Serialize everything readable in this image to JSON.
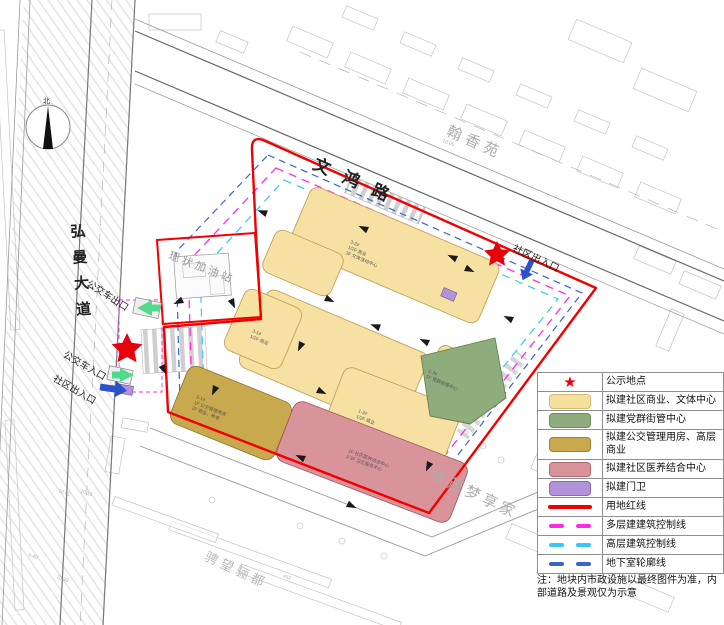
{
  "map": {
    "roads": {
      "top": "文鸿路",
      "left": "弘曼大道"
    },
    "places": {
      "hanxiangyuan": "翰香苑",
      "shimao": "世茂梦享家",
      "chengwang": "骋望骊都",
      "gas_station": "现状加油站"
    },
    "entrances": {
      "bus_exit": "公交车出口",
      "bus_entrance": "公交车入口",
      "community_left": "社区出入口",
      "community_topright": "社区出入口"
    },
    "compass_north": "北",
    "annotations": {
      "building_top": [
        "3-2#",
        "1/2F 商业",
        "3F 文体活动中心"
      ],
      "building_mid": [
        "3-1#",
        "1/2F 商业"
      ],
      "building_br": [
        "1-2#",
        "1/2F 商业"
      ],
      "building_khaki": [
        "2-1#",
        "1F 公交管理用房",
        "2F 商业、养老"
      ],
      "building_pink": [
        "1F 社区医养结合中心",
        "2-3F 卫生服务中心"
      ],
      "building_green": [
        "1-3#",
        "1F 党群街管中心"
      ]
    },
    "elevations": [
      "10.02",
      "10.15",
      "9.40",
      "10.38",
      "10.05",
      "e11"
    ]
  },
  "legend": {
    "items": [
      {
        "type": "star",
        "glyph": "★",
        "label": "公示地点",
        "color": "#E60012"
      },
      {
        "type": "swatch",
        "label": "拟建社区商业、文体中心",
        "color": "#F5DF9E"
      },
      {
        "type": "swatch",
        "label": "拟建党群街管中心",
        "color": "#8FAC7D"
      },
      {
        "type": "swatch",
        "label": "拟建公交管理用房、高层商业",
        "color": "#C9A94E"
      },
      {
        "type": "swatch",
        "label": "拟建社区医养结合中心",
        "color": "#D98F96"
      },
      {
        "type": "swatch",
        "label": "拟建门卫",
        "color": "#B292D8"
      },
      {
        "type": "line",
        "label": "用地红线",
        "color": "#F20000"
      },
      {
        "type": "dash",
        "label": "多层建建筑控制线",
        "color": "#FF2BE2"
      },
      {
        "type": "dash",
        "label": "高层建筑控制线",
        "color": "#35C8F5"
      },
      {
        "type": "dash",
        "label": "地下室轮廓线",
        "color": "#3A66C8"
      }
    ],
    "note": "注：地块内市政设施以最终图件为准，内部道路及景观仅为示意"
  },
  "colors": {
    "boundary_red": "#F20000",
    "multi_storey_control": "#FF2BE2",
    "highrise_control": "#35C8F5",
    "basement_outline": "#3A66C8",
    "commercial_yellow": "#F6E1A2",
    "party_green": "#8FAC7D",
    "bus_khaki": "#C9A94E",
    "medical_pink": "#D9949B",
    "gatehouse_purple": "#B292D8"
  }
}
